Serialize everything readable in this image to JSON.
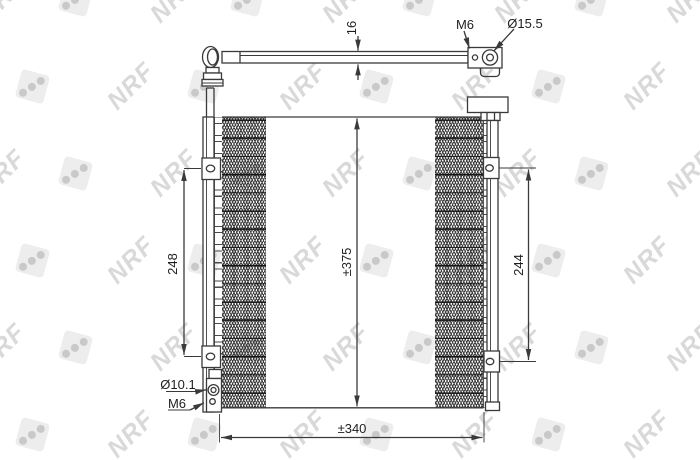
{
  "watermark": {
    "text": "NRF"
  },
  "dims": {
    "thickness": "16",
    "left_height": "248",
    "overall_height": "±375",
    "right_height": "244",
    "overall_width": "±340"
  },
  "labels": {
    "thread_top": "M6",
    "port_diameter": "Ø15.5",
    "mount_hole_diameter": "Ø10.1",
    "thread_bottom": "M6"
  },
  "colors": {
    "line": "#3a3a3a",
    "watermark_text": "#d9d9d9",
    "dice_fill": "#ededed",
    "dice_dot": "#c9c9c9"
  }
}
